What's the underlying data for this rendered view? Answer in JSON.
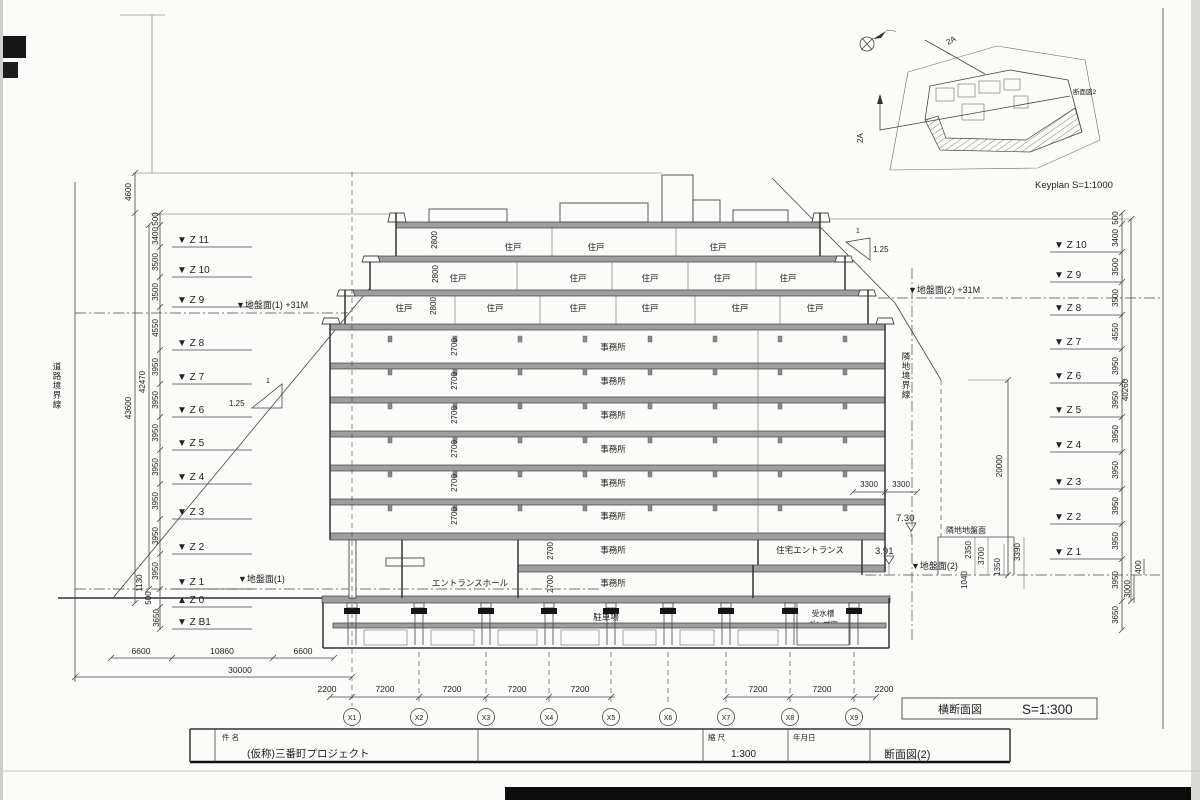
{
  "labels": {
    "road_boundary": "道路境界線",
    "neighbor_boundary": "隣地境界線",
    "ground1_plus31": "▼地盤面(1) +31M",
    "ground2_plus31": "▼地盤面(2) +31M",
    "ground1": "▼地盤面(1)",
    "ground2": "▼地盤面(2)",
    "neighbor_ground": "隣地地盤面",
    "lv_730": "7.30",
    "lv_391": "3.91",
    "slope_num_left": "1",
    "slope_val_left": "1.25",
    "slope_num_right": "1",
    "slope_val_right": "1.25"
  },
  "rooms": {
    "residential": "住戸",
    "office": "事務所",
    "entrance_hall": "エントランスホール",
    "residential_entrance": "住宅エントランス",
    "parking": "駐車場",
    "pump_room_line1": "受水槽",
    "pump_room_line2": "ポンプ室"
  },
  "levels_left": [
    "▼ Z 11",
    "▼ Z 10",
    "▼ Z  9",
    "▼ Z  8",
    "▼ Z  7",
    "▼ Z  6",
    "▼ Z  5",
    "▼ Z  4",
    "▼ Z  3",
    "▼ Z  2",
    "▼ Z  1",
    "▲ Z  0",
    "▼ Z B1"
  ],
  "levels_right": [
    "▼ Z 10",
    "▼ Z  9",
    "▼ Z  8",
    "▼ Z  7",
    "▼ Z  6",
    "▼ Z  5",
    "▼ Z  4",
    "▼ Z  3",
    "▼ Z  2",
    "▼ Z  1"
  ],
  "dims_left": [
    "4600",
    "500",
    "3400",
    "3500",
    "3500",
    "4550",
    "3950",
    "3950",
    "3950",
    "3950",
    "3950",
    "3950",
    "3950",
    "1130",
    "500",
    "3650",
    "42470",
    "43600"
  ],
  "dims_right": [
    "500",
    "3400",
    "3500",
    "3500",
    "4550",
    "3950",
    "3950",
    "3950",
    "3950",
    "3950",
    "3950",
    "3950",
    "3650",
    "40260",
    "400",
    "3000"
  ],
  "dims_floor": [
    "2800",
    "2800",
    "2800",
    "2700",
    "2700",
    "2700",
    "2700",
    "2700",
    "2700",
    "2700",
    "2700"
  ],
  "dims_right_cluster": [
    "3300",
    "3300",
    "2350",
    "3700",
    "1350",
    "3390",
    "1040",
    "20000"
  ],
  "dims_road": [
    "6600",
    "10860",
    "6600",
    "30000"
  ],
  "dims_grid": [
    "2200",
    "7200",
    "7200",
    "7200",
    "7200",
    "7200",
    "7200",
    "2200"
  ],
  "grid_bubbles": [
    "X1",
    "X2",
    "X3",
    "X4",
    "X5",
    "X6",
    "X7",
    "X8",
    "X9"
  ],
  "keyplan": {
    "caption": "Keyplan  S=1:1000",
    "cut_label": "2A",
    "cut_label2": "2A",
    "section_ref": "断面図2"
  },
  "sheet": {
    "drawing_type": "横断面図",
    "drawing_scale": "S=1:300"
  },
  "title_block": {
    "field_name": "件 名",
    "project": "(仮称)三番町プロジェクト",
    "field_scale": "縮 尺",
    "scale": "1:300",
    "field_date": "年月日",
    "drawing_no": "断面図(2)"
  }
}
